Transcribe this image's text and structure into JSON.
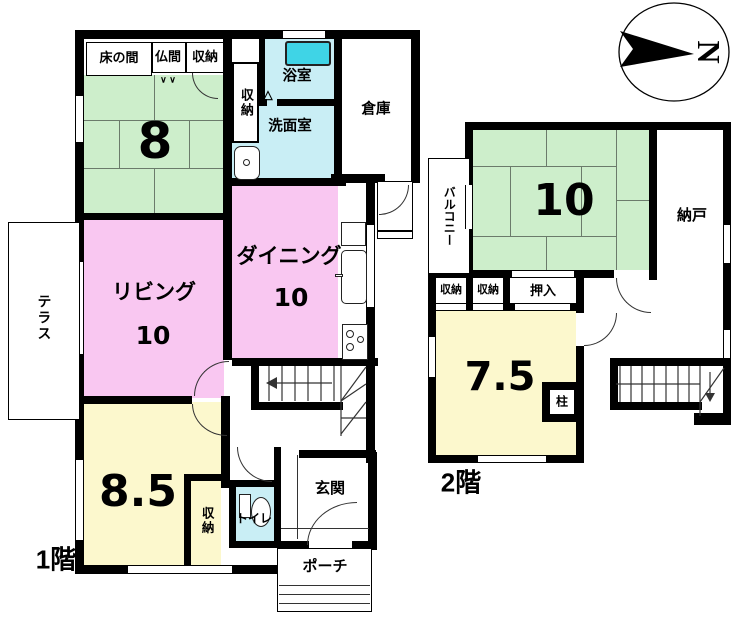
{
  "compass": {
    "north": "N"
  },
  "icons": {
    "bath_door": "△",
    "closet_door": "∨ ∨"
  },
  "floor1": {
    "label": "1階",
    "rooms": {
      "tokonoma": "床の間",
      "butsuma": "仏間",
      "closet_top": "収納",
      "closet_hall": "収納",
      "tatami8_size": "8",
      "bath": "浴室",
      "washroom": "洗面室",
      "storehouse": "倉庫",
      "living": "リビング",
      "living_size": "10",
      "dining": "ダイニング",
      "dining_size": "10",
      "room85_size": "8.5",
      "closet_85": "収納",
      "toilet": "トイレ",
      "entrance": "玄関",
      "porch": "ポーチ",
      "terrace": "テラス"
    }
  },
  "floor2": {
    "label": "2階",
    "rooms": {
      "balcony": "バルコニー",
      "tatami10_size": "10",
      "storeroom": "納戸",
      "closet_a": "収納",
      "closet_b": "収納",
      "oshiire": "押入",
      "room75_size": "7.5",
      "pillar": "柱"
    }
  },
  "colors": {
    "tatami_green": "#cdeecb",
    "room_pink": "#f9c7f1",
    "room_yellow": "#fcf8cd",
    "wet_cyan": "#c9eef5",
    "bathtub_cyan": "#3fd4e6",
    "wall_black": "#000000"
  }
}
